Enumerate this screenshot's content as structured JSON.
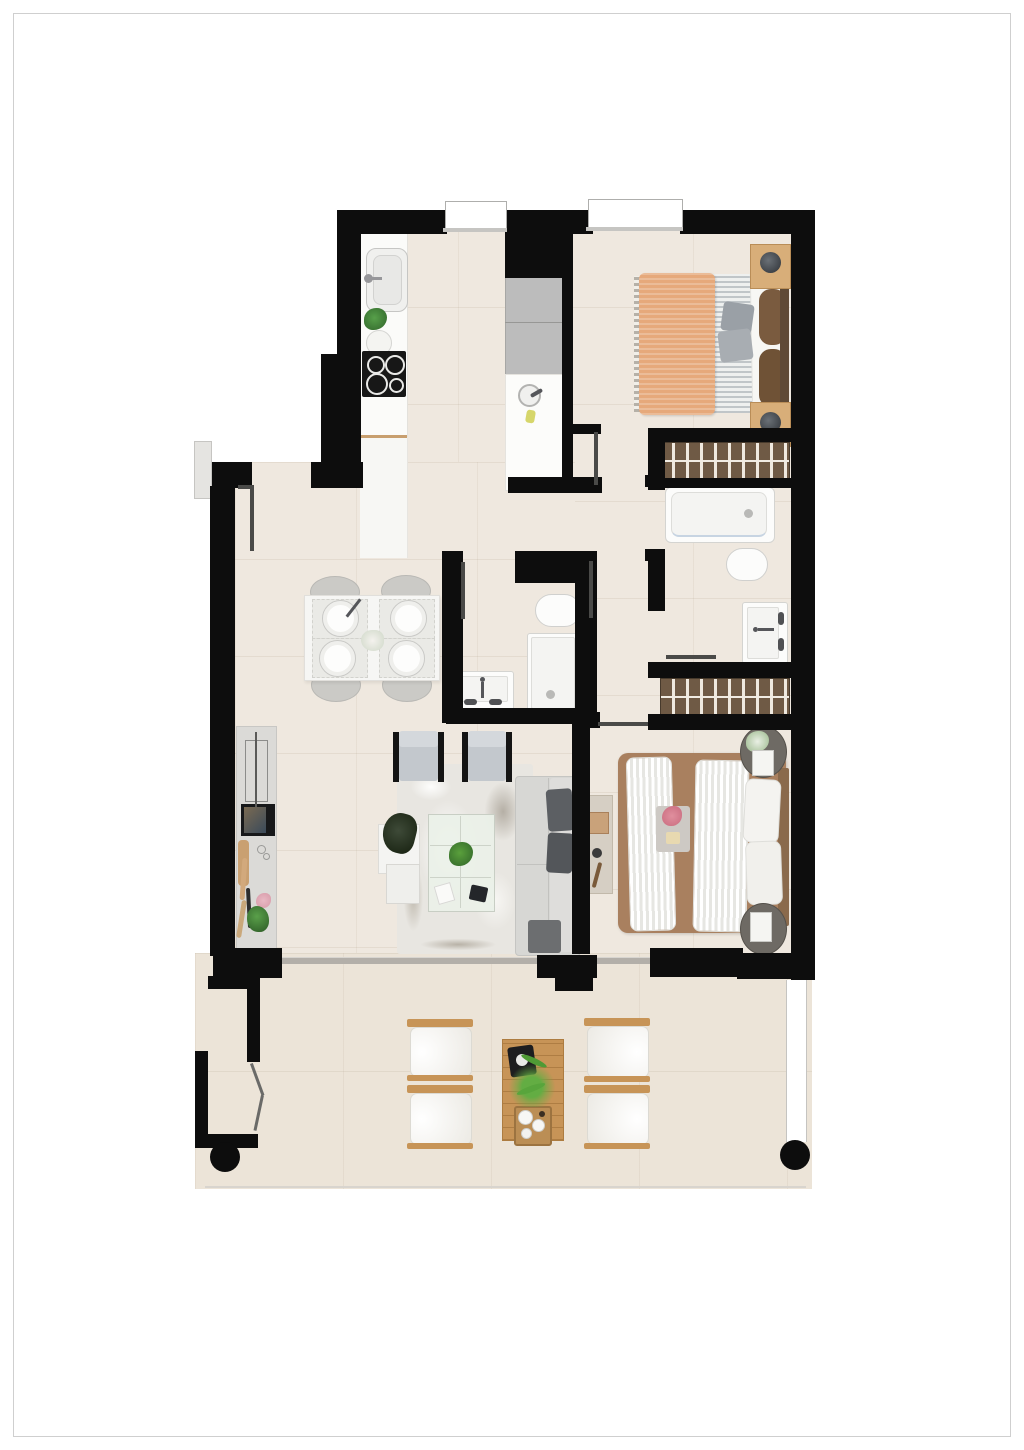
{
  "document": {
    "type": "floor-plan",
    "title": "Two-bedroom apartment floor plan with terrace",
    "visible_text": []
  },
  "palette": {
    "page_background": "#ffffff",
    "frame_border": "#cfcfcf",
    "wall_black": "#0d0d0d",
    "floor_beige": "#efe8df",
    "terrace_beige": "#ece4d8",
    "wood_tan": "#c79457",
    "wardrobe_brown": "#6f5a45",
    "blanket_orange": "#e6a97b",
    "bed2_brown": "#a9805f",
    "sofa_gray": "#d7d7d4",
    "cushion_dark": "#5c5f63",
    "appliance_gray": "#bcbcbc",
    "fixture_white": "#fcfcfb",
    "plant_green": "#4e8f43",
    "flower_pink": "#e8b7c2"
  },
  "rooms": {
    "kitchen": {
      "label": "Kitchen",
      "items": [
        "counter with sink",
        "cooktop with 4 burners",
        "potted plant",
        "tall gray appliance unit",
        "island worktop with sink"
      ]
    },
    "entry": {
      "label": "Entry / hallway",
      "items": [
        "entrance door",
        "sidelight"
      ]
    },
    "bedroom_1": {
      "label": "Bedroom 1",
      "items": [
        "double bed with orange throw",
        "two wooden nightstands with lamps",
        "built-in wardrobe"
      ]
    },
    "bathroom_1": {
      "label": "Bathroom 1",
      "items": [
        "bathtub",
        "toilet",
        "washbasin vanity",
        "built-in wardrobe"
      ]
    },
    "bathroom_2": {
      "label": "Bathroom 2",
      "items": [
        "shower tray",
        "toilet",
        "washbasin vanity"
      ]
    },
    "dining": {
      "label": "Dining area",
      "items": [
        "table set for four",
        "four oval chairs",
        "four plates",
        "centerpiece"
      ]
    },
    "living": {
      "label": "Living room",
      "items": [
        "corner sofa with dark cushions",
        "two armchairs",
        "glass coffee table with plant",
        "mottled rug",
        "TV sideboard",
        "nesting side tables",
        "ottoman",
        "floor plant"
      ]
    },
    "bedroom_2": {
      "label": "Bedroom 2",
      "items": [
        "double bed with brown cover and striped runners",
        "two round dark nightstands",
        "bench console"
      ]
    },
    "terrace": {
      "label": "Terrace",
      "items": [
        "four wooden lounge chairs with white cushions",
        "wooden coffee table with plant and trays",
        "glass balustrade",
        "two round columns",
        "bi-fold corner door"
      ]
    }
  }
}
